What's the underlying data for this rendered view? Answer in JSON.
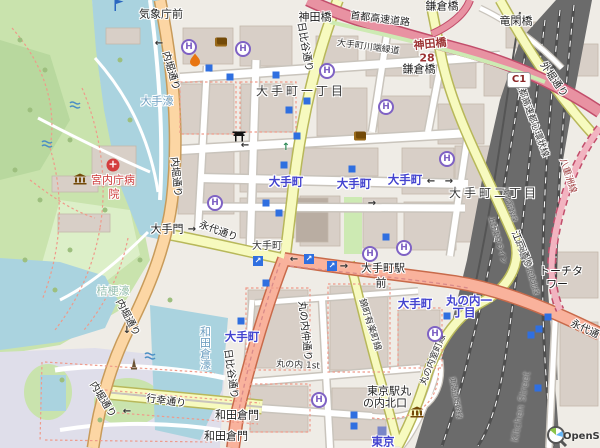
{
  "map": {
    "attribution": "OpenStreetMap",
    "colors": {
      "background": "#efece6",
      "water": "#aad3df",
      "park": "#c9e3ad",
      "pedestrian_area": "#dfdeea",
      "building": "#d8cfc7",
      "railway": "#6b6b6b",
      "motorway": "#e892a2",
      "trunk": "#f9b29c",
      "primary": "#fcd6a4",
      "secondary": "#f7fabf",
      "station_text": "#4343cf",
      "helipad": "#7f62c4",
      "subway_entrance": "#2f6fe0",
      "hospital_text": "#cc3838"
    },
    "labels": [
      {
        "n": "label-bus-kishochomae",
        "t": "気象庁前",
        "x": 161,
        "y": 14,
        "c": "poi",
        "r": 0
      },
      {
        "n": "label-road-uchibori-1",
        "t": "内堀通り",
        "x": 170,
        "y": 71,
        "c": "road",
        "r": 74
      },
      {
        "n": "label-water-otebori",
        "t": "大手濠",
        "x": 157,
        "y": 101,
        "c": "water",
        "r": 0
      },
      {
        "n": "label-bridge-kandabashi",
        "t": "神田橋",
        "x": 315,
        "y": 17,
        "c": "poi",
        "r": 0
      },
      {
        "n": "label-road-shuto-expwy",
        "t": "首都高速道路",
        "x": 380,
        "y": 20,
        "c": "road",
        "r": 7
      },
      {
        "n": "label-bridge-kamakurabashi-top",
        "t": "鎌倉橋",
        "x": 442,
        "y": 6,
        "c": "poi",
        "r": 0
      },
      {
        "n": "label-bridge-ryukanbashi",
        "t": "竜閑橋",
        "x": 516,
        "y": 21,
        "c": "poi",
        "r": 0
      },
      {
        "n": "label-exit-kandabashi",
        "t": "神田橋",
        "x": 430,
        "y": 44,
        "c": "mred",
        "r": -6
      },
      {
        "n": "label-exit-ref-28",
        "t": "28",
        "x": 427,
        "y": 58,
        "c": "mred",
        "r": 0
      },
      {
        "n": "label-bridge-kamakurabashi",
        "t": "鎌倉橋",
        "x": 419,
        "y": 69,
        "c": "poi",
        "r": 0
      },
      {
        "n": "label-road-sotobori",
        "t": "外堀通り",
        "x": 553,
        "y": 80,
        "c": "road",
        "r": 55
      },
      {
        "n": "label-road-kawabata-ryokudo",
        "t": "大手町川端緑道",
        "x": 368,
        "y": 48,
        "c": "roadsm",
        "r": 8
      },
      {
        "n": "label-road-hibiya-north",
        "t": "日比谷通り",
        "x": 304,
        "y": 47,
        "c": "road",
        "r": 80
      },
      {
        "n": "label-place-otemachi-1chome",
        "t": "大手町一丁目",
        "x": 301,
        "y": 91,
        "c": "place",
        "r": 0
      },
      {
        "n": "label-road-shuto-kanjo",
        "t": "首都高速都心環状線",
        "x": 531,
        "y": 119,
        "c": "roadsm",
        "r": 70
      },
      {
        "n": "label-road-yaesu-line",
        "t": "八重洲線",
        "x": 567,
        "y": 176,
        "c": "mredsm",
        "r": 72
      },
      {
        "n": "label-road-uchibori-2",
        "t": "内堀通り",
        "x": 175,
        "y": 177,
        "c": "road",
        "r": 84
      },
      {
        "n": "label-kunaicho-hospital-1",
        "t": "宮内庁病",
        "x": 113,
        "y": 180,
        "c": "hosp",
        "r": 0
      },
      {
        "n": "label-kunaicho-hospital-2",
        "t": "院",
        "x": 114,
        "y": 194,
        "c": "hosp",
        "r": 0
      },
      {
        "n": "label-station-otemachi-1",
        "t": "大手町",
        "x": 286,
        "y": 182,
        "c": "station",
        "r": 0
      },
      {
        "n": "label-station-otemachi-2",
        "t": "大手町",
        "x": 354,
        "y": 184,
        "c": "station",
        "r": 0
      },
      {
        "n": "label-station-otemachi-3",
        "t": "大手町",
        "x": 405,
        "y": 180,
        "c": "station",
        "r": 0
      },
      {
        "n": "label-place-otemachi-2chome",
        "t": "大手町二丁目",
        "x": 494,
        "y": 193,
        "c": "place",
        "r": 0
      },
      {
        "n": "label-road-edo-dori",
        "t": "江戸通り",
        "x": 521,
        "y": 250,
        "c": "road",
        "r": 68
      },
      {
        "n": "label-gate-otemon",
        "t": "大手門",
        "x": 167,
        "y": 229,
        "c": "poi",
        "r": 0
      },
      {
        "n": "label-road-eitai-west",
        "t": "永代通り",
        "x": 218,
        "y": 232,
        "c": "road",
        "r": 20
      },
      {
        "n": "label-otemachi-minor",
        "t": "大手町",
        "x": 267,
        "y": 247,
        "c": "poism",
        "r": 0
      },
      {
        "n": "label-otemachi-ekimae-1",
        "t": "大手町駅",
        "x": 383,
        "y": 268,
        "c": "poi",
        "r": 0
      },
      {
        "n": "label-otemachi-ekimae-2",
        "t": "前",
        "x": 381,
        "y": 283,
        "c": "poi",
        "r": 0
      },
      {
        "n": "label-torch-tower-1",
        "t": "トーチタ",
        "x": 561,
        "y": 271,
        "c": "poi",
        "r": 0
      },
      {
        "n": "label-torch-tower-2",
        "t": "ワー",
        "x": 557,
        "y": 284,
        "c": "poi",
        "r": 0
      },
      {
        "n": "label-water-kikyobori",
        "t": "桔梗濠",
        "x": 113,
        "y": 291,
        "c": "waterlight",
        "r": 0
      },
      {
        "n": "label-road-uchibori-3",
        "t": "内堀通り",
        "x": 127,
        "y": 318,
        "c": "road",
        "r": 62
      },
      {
        "n": "label-place-marunouchi-1chome-a",
        "t": "丸の内一",
        "x": 469,
        "y": 301,
        "c": "station",
        "r": 0
      },
      {
        "n": "label-place-marunouchi-1chome-b",
        "t": "丁目",
        "x": 464,
        "y": 313,
        "c": "station",
        "r": 0
      },
      {
        "n": "label-station-otemachi-4",
        "t": "大手町",
        "x": 415,
        "y": 304,
        "c": "station",
        "r": 0
      },
      {
        "n": "label-road-eitai-east",
        "t": "永代通り",
        "x": 589,
        "y": 332,
        "c": "road",
        "r": 25
      },
      {
        "n": "label-road-nishikicho-yurakucho",
        "t": "錦町有楽町線",
        "x": 369,
        "y": 325,
        "c": "roadsm",
        "r": 72
      },
      {
        "n": "label-road-marunouchi-naka",
        "t": "丸の内仲通り",
        "x": 304,
        "y": 331,
        "c": "road",
        "r": 84
      },
      {
        "n": "label-station-otemachi-5",
        "t": "大手町",
        "x": 242,
        "y": 337,
        "c": "station",
        "r": 0
      },
      {
        "n": "label-water-wadakurabori",
        "t": "和田倉濠",
        "x": 205,
        "y": 348,
        "c": "watervert",
        "r": 0
      },
      {
        "n": "label-road-hibiya-south",
        "t": "日比谷通り",
        "x": 230,
        "y": 374,
        "c": "road",
        "r": 82
      },
      {
        "n": "label-road-marunouchi-1st",
        "t": "丸の内 1st",
        "x": 298,
        "y": 366,
        "c": "roadsm",
        "r": 3
      },
      {
        "n": "label-road-marunouchi-muromachi",
        "t": "丸の内室町線",
        "x": 434,
        "y": 360,
        "c": "roadsm",
        "r": -68
      },
      {
        "n": "label-road-gyoko-dori",
        "t": "行幸通り",
        "x": 166,
        "y": 402,
        "c": "road",
        "r": 8
      },
      {
        "n": "label-road-uchibori-4",
        "t": "内堀通り",
        "x": 102,
        "y": 400,
        "c": "road",
        "r": 58
      },
      {
        "n": "label-gate-wadakuramon-1",
        "t": "和田倉門",
        "x": 237,
        "y": 415,
        "c": "poi",
        "r": 0
      },
      {
        "n": "label-gate-wadakuramon-2",
        "t": "和田倉門",
        "x": 226,
        "y": 436,
        "c": "poi",
        "r": 0
      },
      {
        "n": "label-tokyo-sta-north-exit-1",
        "t": "東京駅丸",
        "x": 389,
        "y": 391,
        "c": "poi",
        "r": 0
      },
      {
        "n": "label-tokyo-sta-north-exit-2",
        "t": "の内北口",
        "x": 385,
        "y": 403,
        "c": "poi",
        "r": 0
      },
      {
        "n": "label-station-tokyo",
        "t": "東京",
        "x": 383,
        "y": 442,
        "c": "station",
        "r": 0
      },
      {
        "n": "label-kitchen-street",
        "t": "Kitchen Street",
        "x": 522,
        "y": 407,
        "c": "gray",
        "r": -80
      },
      {
        "n": "label-rail-tohoku-shinkansen",
        "t": "東北新幹線",
        "x": 509,
        "y": 205,
        "c": "rail",
        "r": 74
      },
      {
        "n": "label-rail-ueno-tokyo-line",
        "t": "上野東京ライン",
        "x": 497,
        "y": 240,
        "c": "rail",
        "r": 74
      },
      {
        "n": "label-rail-yamanote",
        "t": "山手線",
        "x": 520,
        "y": 250,
        "c": "rail",
        "r": 74
      },
      {
        "n": "label-rail-keihin-tohoku",
        "t": "京浜東北線",
        "x": 531,
        "y": 278,
        "c": "rail",
        "r": 74
      },
      {
        "n": "label-rail-tokaido-shinkansen",
        "t": "東海道新幹線",
        "x": 455,
        "y": 398,
        "c": "rail",
        "r": 80
      },
      {
        "n": "label-shield-c1",
        "t": "C1",
        "x": 519,
        "y": 80,
        "c": "shield",
        "r": 0
      }
    ],
    "icons": [
      {
        "n": "flag-icon",
        "t": "flag",
        "x": 119,
        "y": 5
      },
      {
        "n": "hospital-cross-icon",
        "t": "cross",
        "x": 113,
        "y": 165
      },
      {
        "n": "museum-icon",
        "t": "museum",
        "x": 80,
        "y": 179
      },
      {
        "n": "museum-icon",
        "t": "museum",
        "x": 417,
        "y": 412
      },
      {
        "n": "fountain-icon",
        "t": "fountain",
        "x": 75,
        "y": 105
      },
      {
        "n": "fountain-icon",
        "t": "fountain",
        "x": 47,
        "y": 144
      },
      {
        "n": "fountain-icon",
        "t": "fountain",
        "x": 150,
        "y": 356
      },
      {
        "n": "monument-icon",
        "t": "monument",
        "x": 134,
        "y": 364
      },
      {
        "n": "torii-shrine-icon",
        "t": "torii",
        "x": 239,
        "y": 136
      },
      {
        "n": "theatre-icon",
        "t": "theatre",
        "x": 221,
        "y": 42
      },
      {
        "n": "theatre-icon",
        "t": "theatre",
        "x": 360,
        "y": 136
      },
      {
        "n": "flame-icon",
        "t": "flame",
        "x": 195,
        "y": 60
      },
      {
        "n": "helipad-icon",
        "t": "helipad",
        "x": 189,
        "y": 47
      },
      {
        "n": "helipad-icon",
        "t": "helipad",
        "x": 243,
        "y": 49
      },
      {
        "n": "helipad-icon",
        "t": "helipad",
        "x": 327,
        "y": 71
      },
      {
        "n": "helipad-icon",
        "t": "helipad",
        "x": 386,
        "y": 107
      },
      {
        "n": "helipad-icon",
        "t": "helipad",
        "x": 447,
        "y": 159
      },
      {
        "n": "helipad-icon",
        "t": "helipad",
        "x": 215,
        "y": 203
      },
      {
        "n": "helipad-icon",
        "t": "helipad",
        "x": 370,
        "y": 254
      },
      {
        "n": "helipad-icon",
        "t": "helipad",
        "x": 404,
        "y": 248
      },
      {
        "n": "helipad-icon",
        "t": "helipad",
        "x": 435,
        "y": 334
      },
      {
        "n": "helipad-icon",
        "t": "helipad",
        "x": 319,
        "y": 400
      },
      {
        "n": "subway-entrance-icon",
        "t": "subway",
        "x": 209,
        "y": 68
      },
      {
        "n": "subway-entrance-icon",
        "t": "subway",
        "x": 230,
        "y": 77
      },
      {
        "n": "subway-entrance-icon",
        "t": "subway",
        "x": 276,
        "y": 75
      },
      {
        "n": "subway-entrance-icon",
        "t": "subway",
        "x": 307,
        "y": 101
      },
      {
        "n": "subway-entrance-icon",
        "t": "subway",
        "x": 289,
        "y": 110
      },
      {
        "n": "subway-entrance-icon",
        "t": "subway",
        "x": 297,
        "y": 136
      },
      {
        "n": "subway-entrance-icon",
        "t": "subway",
        "x": 284,
        "y": 165
      },
      {
        "n": "subway-entrance-icon",
        "t": "subway",
        "x": 352,
        "y": 169
      },
      {
        "n": "subway-entrance-icon",
        "t": "subway",
        "x": 266,
        "y": 203
      },
      {
        "n": "subway-entrance-icon",
        "t": "subway",
        "x": 279,
        "y": 213
      },
      {
        "n": "subway-entrance-icon",
        "t": "subway",
        "x": 386,
        "y": 237
      },
      {
        "n": "subway-entrance-icon",
        "t": "subway",
        "x": 266,
        "y": 283
      },
      {
        "n": "subway-entrance-icon",
        "t": "subway",
        "x": 241,
        "y": 321
      },
      {
        "n": "subway-entrance-icon",
        "t": "subway",
        "x": 354,
        "y": 415
      },
      {
        "n": "subway-entrance-icon",
        "t": "subway",
        "x": 354,
        "y": 426
      },
      {
        "n": "subway-entrance-icon",
        "t": "subway",
        "x": 447,
        "y": 316
      },
      {
        "n": "subway-entrance-icon",
        "t": "subway",
        "x": 548,
        "y": 317
      },
      {
        "n": "subway-entrance-icon",
        "t": "subway",
        "x": 539,
        "y": 329
      },
      {
        "n": "subway-entrance-icon",
        "t": "subway",
        "x": 531,
        "y": 335
      },
      {
        "n": "subway-entrance-icon",
        "t": "subway",
        "x": 538,
        "y": 388
      },
      {
        "n": "elevator-icon",
        "t": "elevator",
        "x": 258,
        "y": 261
      },
      {
        "n": "elevator-icon",
        "t": "elevator",
        "x": 309,
        "y": 259
      },
      {
        "n": "elevator-icon",
        "t": "elevator",
        "x": 332,
        "y": 266
      },
      {
        "n": "station-square-icon",
        "t": "stationsq",
        "x": 382,
        "y": 431
      },
      {
        "n": "oneway-arrow-icon",
        "t": "arrow-l",
        "x": 159,
        "y": 44
      },
      {
        "n": "oneway-arrow-icon",
        "t": "arrow-l",
        "x": 245,
        "y": 146
      },
      {
        "n": "oneway-arrow-icon",
        "t": "arrow-l",
        "x": 431,
        "y": 182
      },
      {
        "n": "oneway-arrow-icon",
        "t": "arrow-l",
        "x": 294,
        "y": 260
      },
      {
        "n": "oneway-arrow-icon",
        "t": "arrow-l",
        "x": 127,
        "y": 412
      },
      {
        "n": "oneway-arrow-icon",
        "t": "arrow-r",
        "x": 449,
        "y": 182
      },
      {
        "n": "oneway-arrow-icon",
        "t": "arrow-r",
        "x": 372,
        "y": 204
      },
      {
        "n": "oneway-arrow-icon",
        "t": "arrow-r",
        "x": 192,
        "y": 230
      },
      {
        "n": "oneway-arrow-icon",
        "t": "arrow-r",
        "x": 344,
        "y": 267
      },
      {
        "n": "oneway-arrow-icon",
        "t": "arrow-d",
        "x": 127,
        "y": 331
      },
      {
        "n": "oneway-arrow-icon",
        "t": "arrow-ug",
        "x": 286,
        "y": 148
      }
    ]
  }
}
